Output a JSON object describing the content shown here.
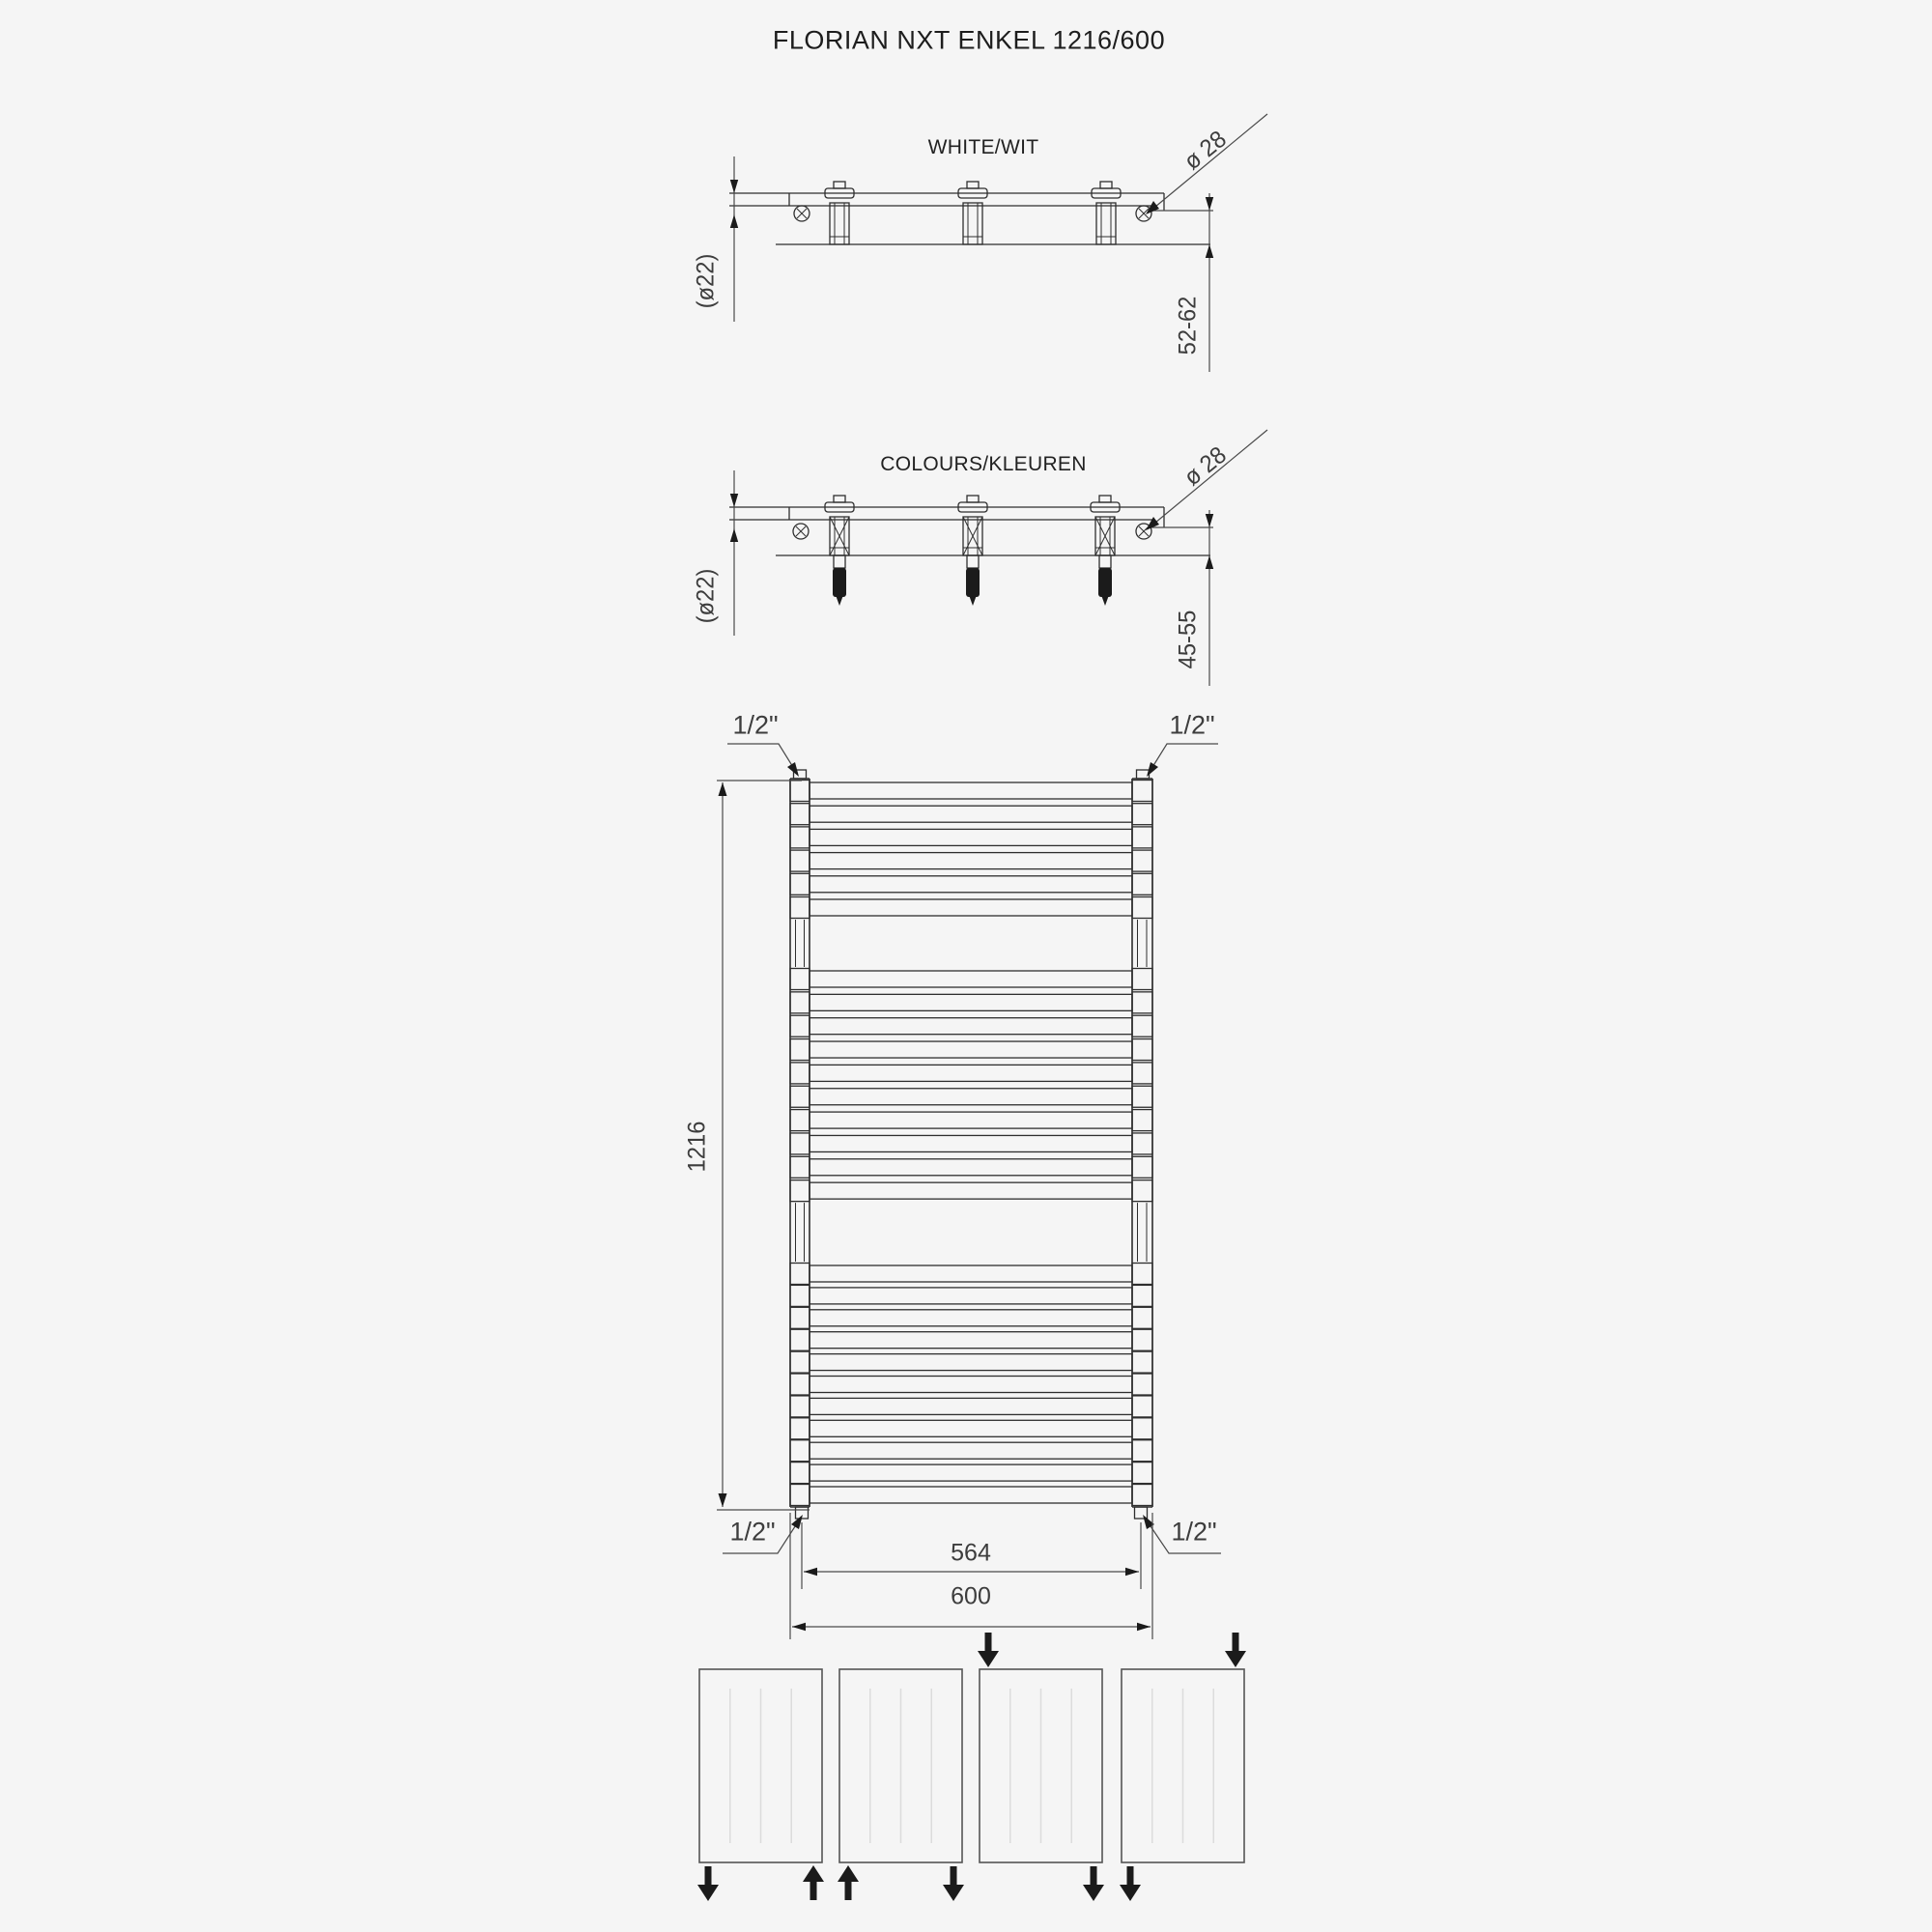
{
  "title": "FLORIAN NXT ENKEL 1216/600",
  "views": {
    "white": {
      "label": "WHITE/WIT",
      "dim_screw": "ø 28",
      "dim_tube": "(ø22)",
      "dim_wall": "52-62"
    },
    "colours": {
      "label": "COLOURS/KLEUREN",
      "dim_screw": "ø 28",
      "dim_tube": "(ø22)",
      "dim_wall": "45-55"
    }
  },
  "front": {
    "height_dim": "1216",
    "pitch_dim": "564",
    "width_dim": "600",
    "conn_top_left": "1/2\"",
    "conn_top_right": "1/2\"",
    "conn_bottom_left": "1/2\"",
    "conn_bottom_right": "1/2\"",
    "tube_groups": [
      6,
      10,
      11
    ],
    "bracket_count": 3
  },
  "connection_schemes": [
    {
      "name": "bottom: out left / in right",
      "arrows": [
        {
          "pos": "bottom-left",
          "dir": "down"
        },
        {
          "pos": "bottom-right",
          "dir": "up"
        }
      ]
    },
    {
      "name": "bottom: in left / out right",
      "arrows": [
        {
          "pos": "bottom-left",
          "dir": "up"
        },
        {
          "pos": "bottom-right",
          "dir": "down"
        }
      ]
    },
    {
      "name": "top-left in / bottom-right out",
      "arrows": [
        {
          "pos": "top-left",
          "dir": "down"
        },
        {
          "pos": "bottom-right",
          "dir": "down"
        }
      ]
    },
    {
      "name": "top-right in / bottom-left out",
      "arrows": [
        {
          "pos": "top-right",
          "dir": "down"
        },
        {
          "pos": "bottom-left",
          "dir": "down"
        }
      ]
    }
  ],
  "colors": {
    "line": "#2e2e2e",
    "dim": "#4a4a4a",
    "arrow_fill": "#1b1b1b",
    "faint": "#dcdcdc",
    "background": "#f5f5f5"
  }
}
